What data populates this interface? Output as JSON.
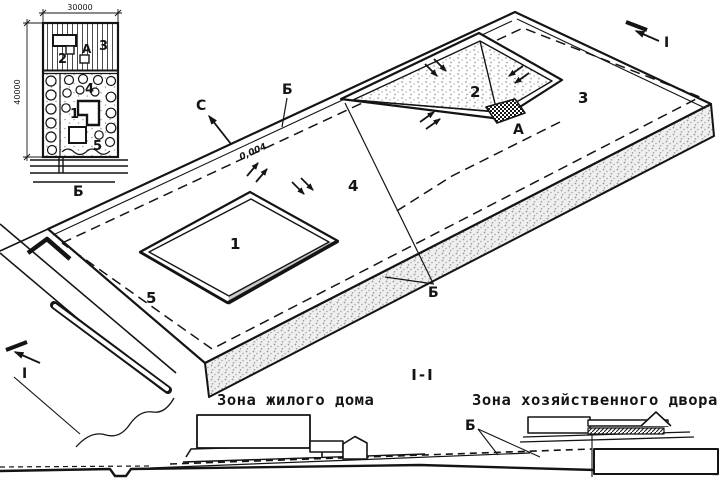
{
  "colors": {
    "ink": "#141414",
    "paper": "#ffffff",
    "shade": "#c9c9c9"
  },
  "inset_plan": {
    "dim_top": "30000",
    "dim_left": "40000",
    "zone2": "2",
    "point_a": "А",
    "zone3": "3",
    "zone4": "4",
    "zone1": "1",
    "zone5": "5",
    "street_label": "Б"
  },
  "axonometric": {
    "north_label": "С",
    "boundary_label_top": "Б",
    "boundary_label_bottom": "Б",
    "slope_value": "0,004",
    "zone1": "1",
    "zone2": "2",
    "zone3": "3",
    "zone4": "4",
    "zone5": "5",
    "drain_label": "А",
    "section_marker_top": "I",
    "section_marker_bottom": "I"
  },
  "section_view": {
    "title": "I-I",
    "left_caption": "Зона жилого дома",
    "right_caption": "Зона хозяйственного двора",
    "boundary_label": "Б"
  }
}
